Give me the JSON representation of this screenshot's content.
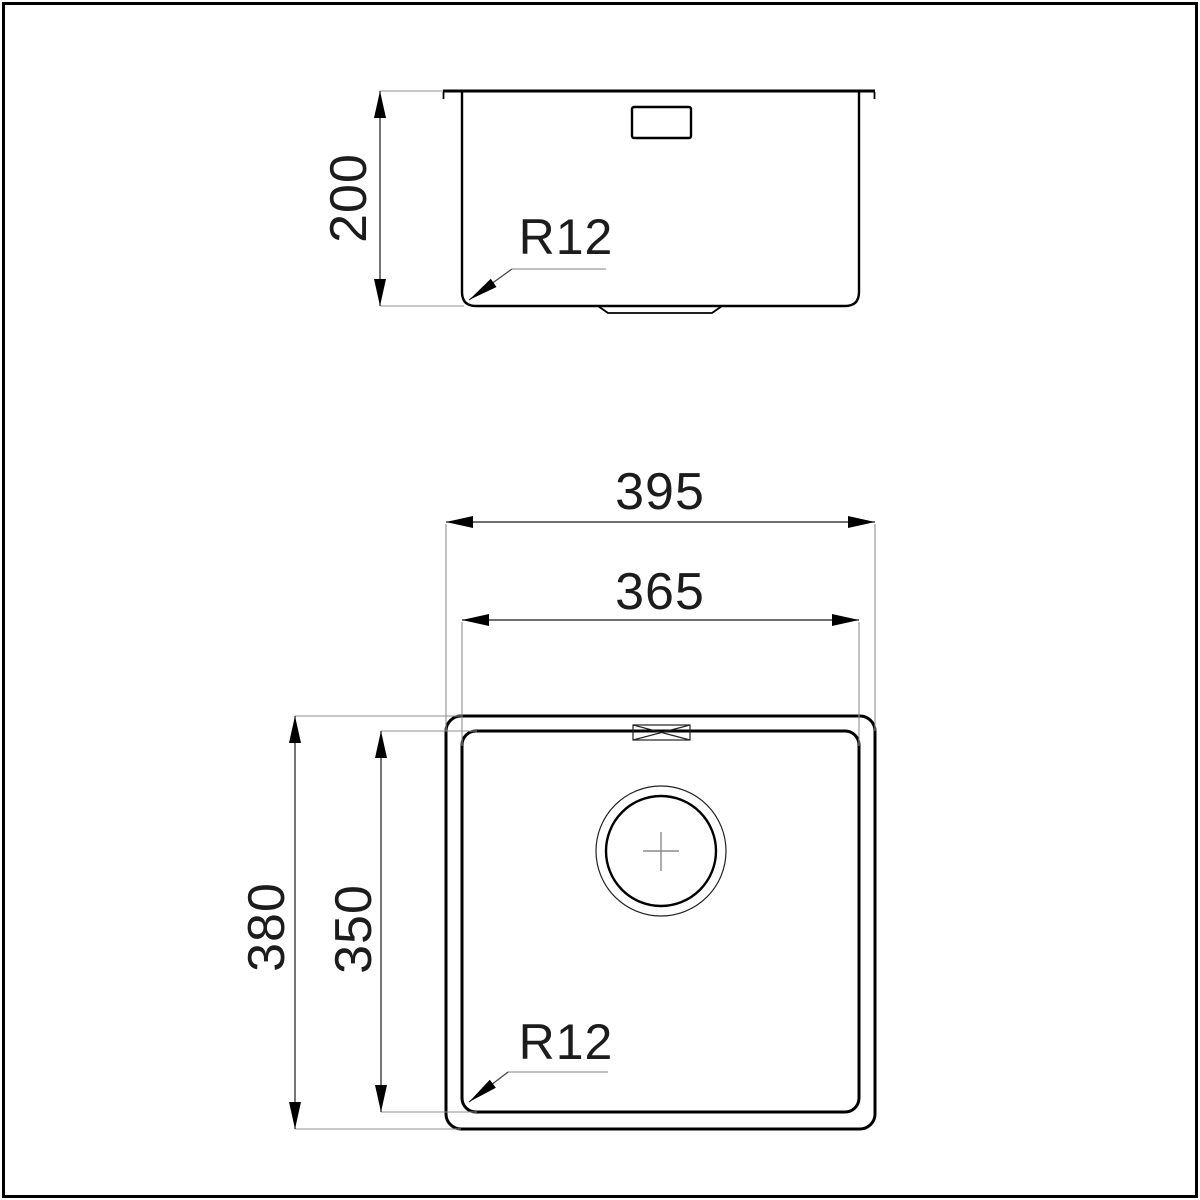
{
  "drawing": {
    "title": "sink technical drawing, section and plan views",
    "colors": {
      "background": "#ffffff",
      "main_line": "#000000",
      "extension_line": "#909090",
      "text": "#1c1c1c"
    }
  },
  "section_view": {
    "depth_dimension": "200",
    "corner_radius_label": "R12"
  },
  "plan_view": {
    "outer_width_dimension": "395",
    "inner_width_dimension": "365",
    "outer_depth_dimension": "380",
    "inner_depth_dimension": "350",
    "corner_radius_label": "R12"
  }
}
